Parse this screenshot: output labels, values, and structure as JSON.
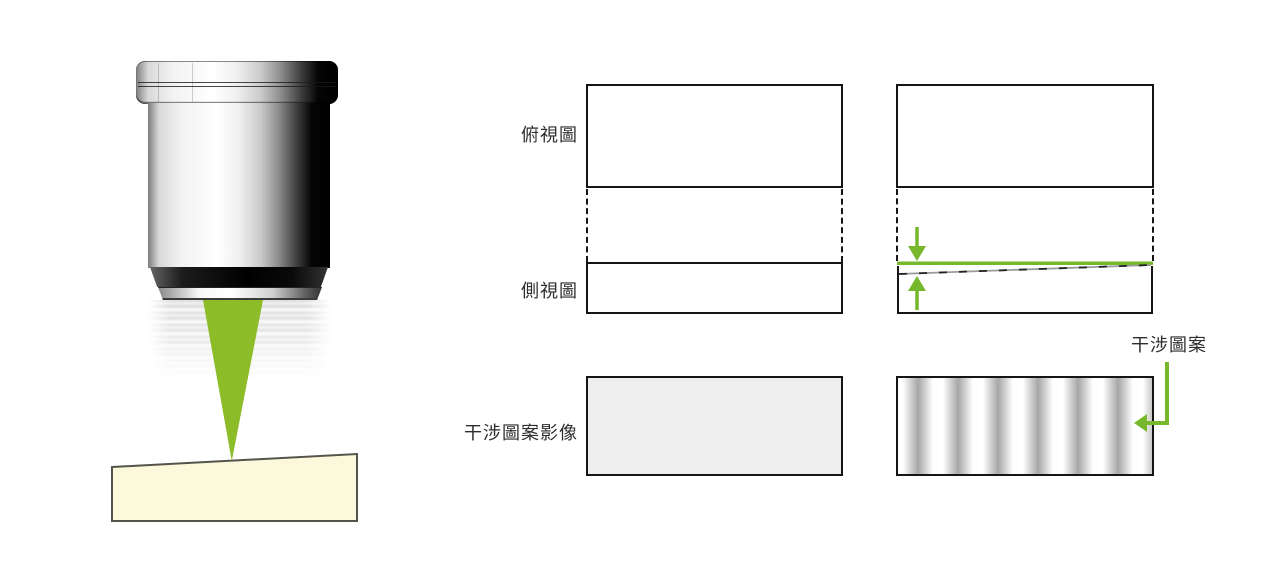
{
  "figure": {
    "description_labels_language": "zh-TW"
  },
  "labels": {
    "top_view": "俯視圖",
    "side_view": "側視圖",
    "interference_image": "干涉圖案影像",
    "interference_pattern": "干涉圖案"
  },
  "colors": {
    "beam_green": "#8cbd29",
    "arrow_green": "#76b72b",
    "sample_fill": "#fbf8dc",
    "sample_stroke": "#54544a",
    "panel_gray": "#eeeeee",
    "fringe_gray": "#a6a6a6",
    "box_border": "#151515",
    "label_text": "#2e2e2e"
  },
  "icons": {
    "down_arrow": "green arrow pointing down to reference line",
    "up_arrow": "green arrow pointing up to tilted surface",
    "elbow_arrow": "green L-shaped arrow pointing left into fringe image"
  }
}
